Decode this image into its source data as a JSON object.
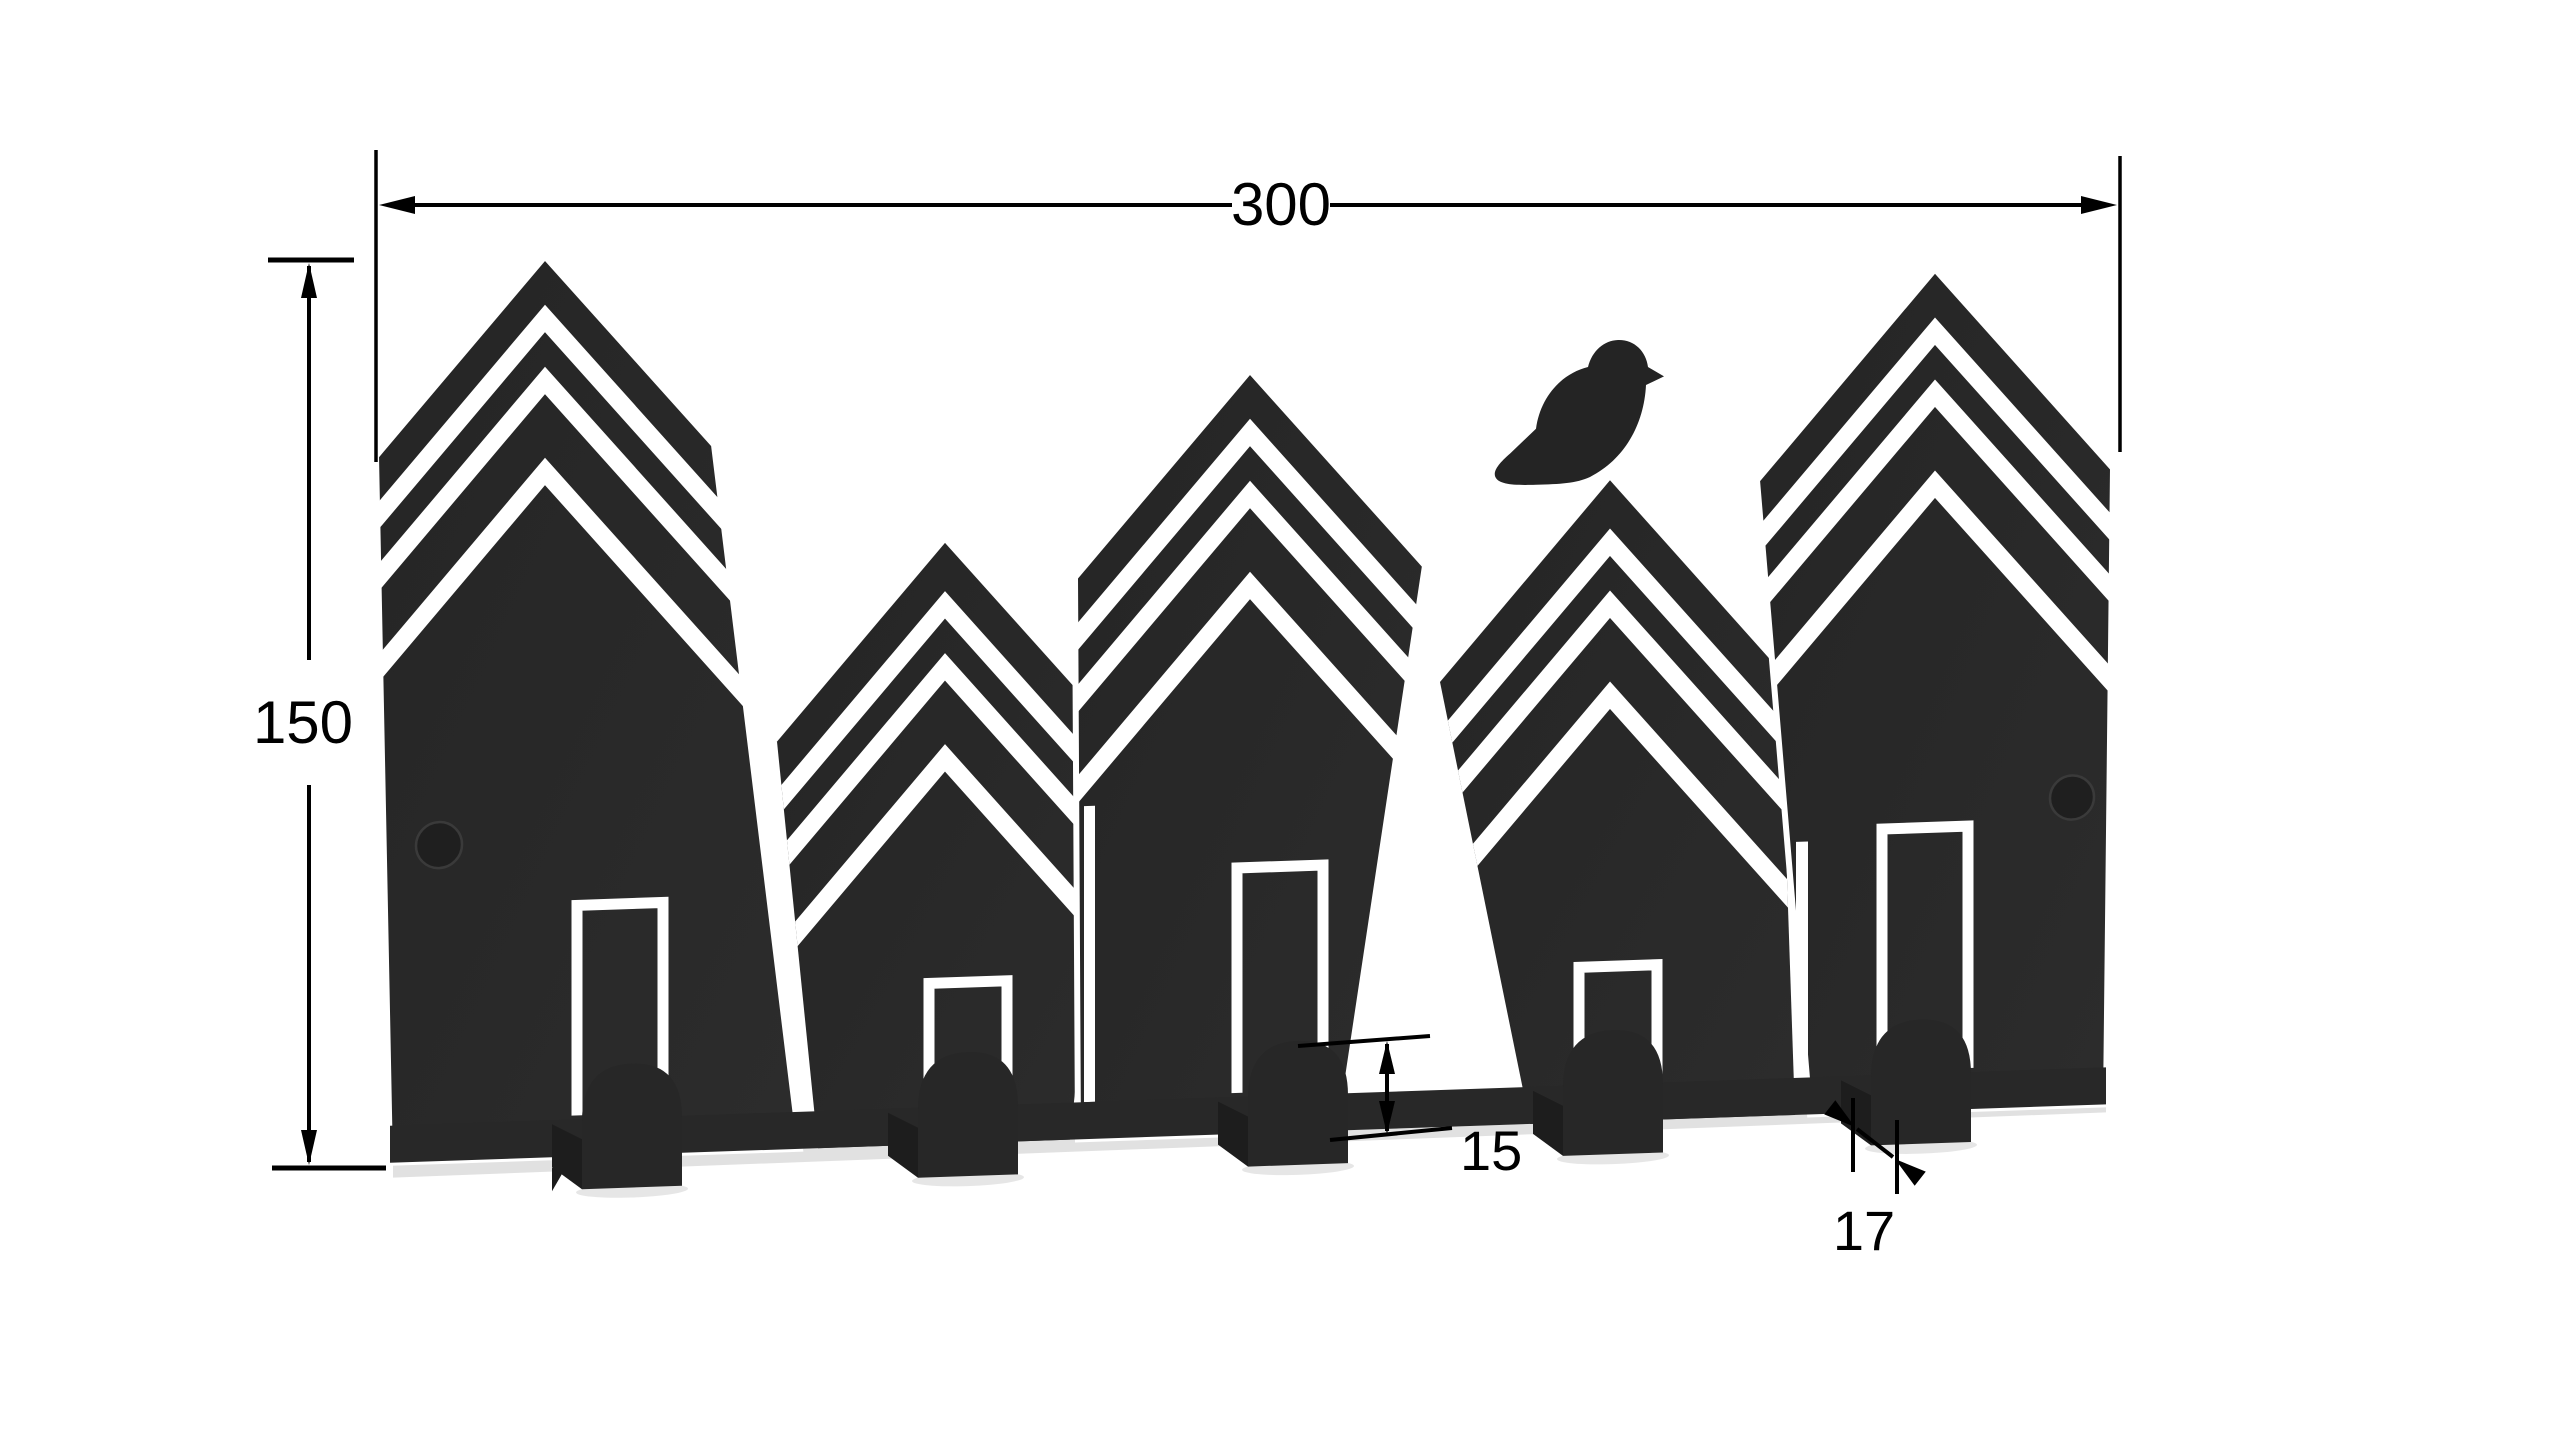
{
  "drawing": {
    "type": "dimensioned technical drawing",
    "subject": "house-silhouette wall key rack with bird",
    "dimensions": {
      "overall_width": "300",
      "overall_height": "150",
      "hook_protrusion": "15",
      "hook_bend_width": "17"
    },
    "features": {
      "houses": 5,
      "hooks": 5,
      "door_cutouts": 5,
      "mounting_holes": 2,
      "bird_count": 1
    },
    "colors": {
      "plate": "#282828",
      "dimension_lines": "#000000",
      "background": "#ffffff",
      "shadow": "#c4c4c4"
    }
  }
}
